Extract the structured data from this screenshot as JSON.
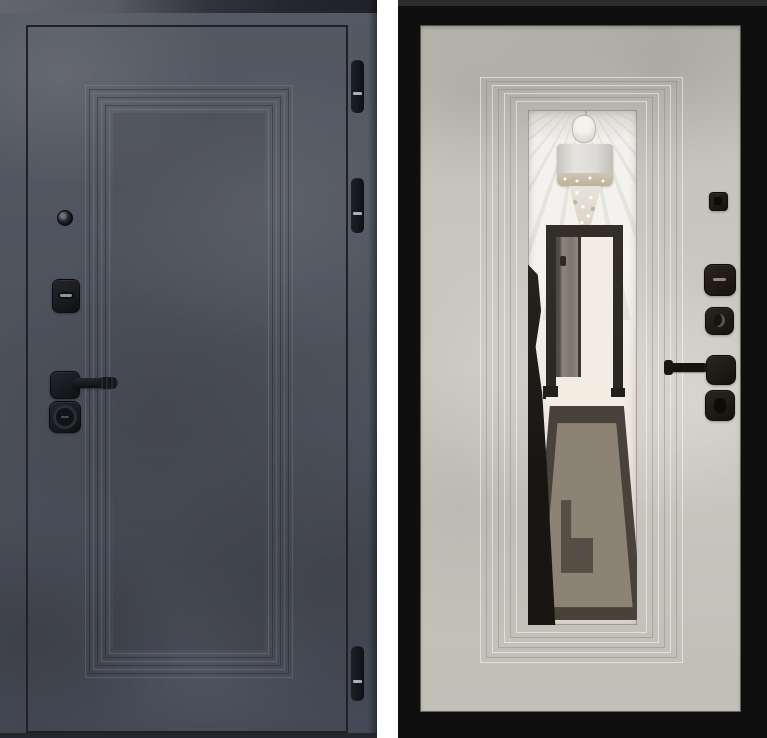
{
  "scene": {
    "left_door": {
      "label": "door-panel-front-dark-concrete",
      "finish_color": "#4d515c",
      "hinge_count": 3,
      "hinges": [
        "hinge-top",
        "hinge-middle",
        "hinge-bottom"
      ],
      "hardware": [
        "peephole",
        "cylinder-lock",
        "lever-handle",
        "deadbolt-thumbturn"
      ],
      "molding": "stepped-rectangular-relief-frame"
    },
    "right_door": {
      "label": "door-panel-back-light-concrete-with-mirror",
      "finish_color": "#c8c5be",
      "frame_color": "#0f0f10",
      "hardware": [
        "peephole-cover",
        "cylinder-lock",
        "keyhole",
        "lever-handle",
        "thumbturn"
      ],
      "molding": "stepped-rectangular-relief-frame",
      "mirror_reflection": [
        "ceiling-light-rays",
        "drum-chandelier-with-crystals",
        "open-interior-door",
        "greek-key-rug",
        "glossy-dark-floor"
      ]
    }
  },
  "colors": {
    "bg_white": "#ffffff",
    "door_dark_base": "#4d515c",
    "door_dark_light": "#555964",
    "door_dark_shadow": "#454955",
    "door_dark_line": "#1f2127",
    "threshold": "#24262c",
    "slot_light": "#8d939e",
    "frame_black": "#0f0f10",
    "panel_light_base": "#c8c5be",
    "reflect_frame": "#332f28",
    "rug_border": "#47423a",
    "rug_field": "#8c8375",
    "rug_block": "#544e45"
  }
}
